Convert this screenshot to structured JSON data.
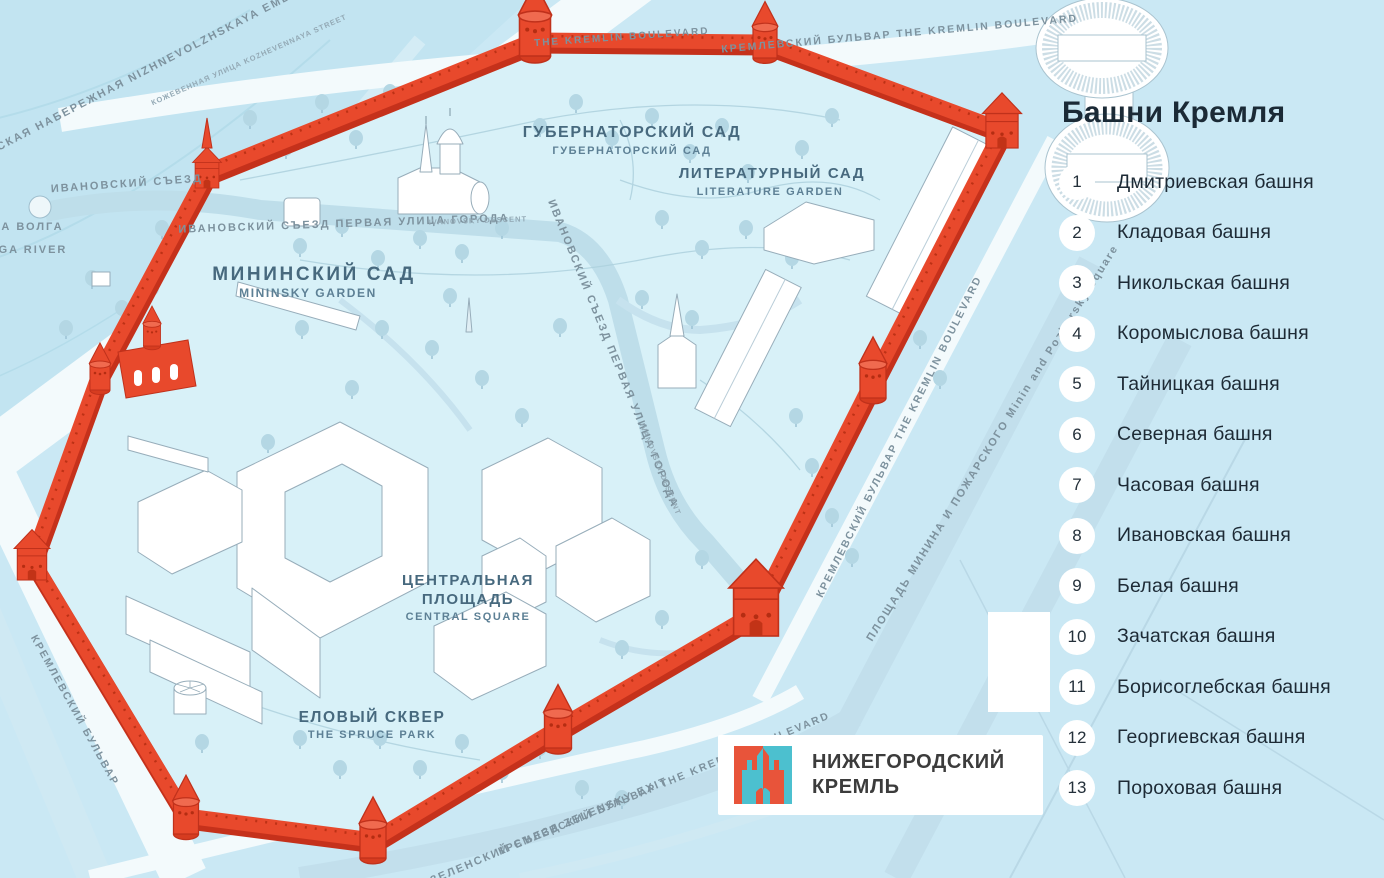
{
  "colors": {
    "background": "#cae8f4",
    "kremlin_interior": "#d8f1f8",
    "wall_red": "#e8492c",
    "wall_outline": "#c0311b",
    "road_white": "#f3fafc",
    "road_blue": "#c2dfec",
    "tree": "#b4d7e4",
    "label_garden": "#47697e",
    "label_street": "#7d929e",
    "legend_text": "#1d2a35"
  },
  "legend": {
    "title": "Башни Кремля",
    "items": [
      {
        "num": "1",
        "label": "Дмитриевская башня"
      },
      {
        "num": "2",
        "label": "Кладовая башня"
      },
      {
        "num": "3",
        "label": "Никольская башня"
      },
      {
        "num": "4",
        "label": "Коромыслова башня"
      },
      {
        "num": "5",
        "label": "Тайницкая башня"
      },
      {
        "num": "6",
        "label": "Северная башня"
      },
      {
        "num": "7",
        "label": "Часовая башня"
      },
      {
        "num": "8",
        "label": "Ивановская башня"
      },
      {
        "num": "9",
        "label": "Белая башня"
      },
      {
        "num": "10",
        "label": "Зачатская башня"
      },
      {
        "num": "11",
        "label": "Борисоглебская башня"
      },
      {
        "num": "12",
        "label": "Георгиевская башня"
      },
      {
        "num": "13",
        "label": "Пороховая башня"
      }
    ]
  },
  "logo": {
    "line1": "НИЖЕГОРОДСКИЙ",
    "line2": "КРЕМЛЬ"
  },
  "map": {
    "labels": {
      "volga_ru": "РЕКА ВОЛГА",
      "volga_en": "VOLGA RIVER",
      "embankment": "НИЖНЕВОЛЖСКАЯ НАБЕРЕЖНАЯ  NIZHNEVOLZHSKAYA EMBANKMENT",
      "kozhevennaya": "КОЖЕВЕННАЯ УЛИЦА  KOZHEVENNAYA STREET",
      "blvd_top_en": "THE KREMLIN BOULEVARD",
      "blvd_top": "КРЕМЛЕВСКИЙ БУЛЬВАР  THE KREMLIN BOULEVARD",
      "blvd_left": "КРЕМЛЕВСКИЙ БУЛЬВАР",
      "ivanovsky_exit": "ИВАНОВСКИЙ  СЪЕЗД",
      "street_inner": "ИВАНОВСКИЙ  СЪЕЗД  ПЕРВАЯ  УЛИЦА ГОРОДА",
      "street_inner_en": "IVANOVSKY DESCENT",
      "street_vert": "ИВАНОВСКИЙ  СЪЕЗД  ПЕРВАЯ  УЛИЦА ГОРОДА",
      "street_vert_en": "IVANOVSKY DESCENT",
      "gubernatorsky_ru": "ГУБЕРНАТОРСКИЙ САД",
      "gubernatorsky_sub": "ГУБЕРНАТОРСКИЙ САД",
      "literature_ru": "ЛИТЕРАТУРНЫЙ САД",
      "literature_en": "LITERATURE GARDEN",
      "mininsky_ru": "МИНИНСКИЙ САД",
      "mininsky_en": "MININSKY GARDEN",
      "central_ru1": "ЦЕНТРАЛЬНАЯ",
      "central_ru2": "ПЛОЩАДЬ",
      "central_en": "CENTRAL SQUARE",
      "spruce_ru": "ЕЛОВЫЙ СКВЕР",
      "spruce_en": "THE SPRUCE PARK",
      "blvd_right": "КРЕМЛЕВСКИЙ БУЛЬВАР  THE KREMLIN BOULEVARD",
      "minin_square": "ПЛОЩАДЬ  МИНИНА  И  ПОЖАРСКОГО   Minin  and  Pozharsky  Square",
      "blvd_bottom": "КРЕМЛЕВСКИЙ БУЛЬВАР  THE KREMLIN BOULEVARD",
      "zelensky": "ЗЕЛЕНСКИЙ СЪЕЗД  ZELENSKY EXIT"
    }
  }
}
